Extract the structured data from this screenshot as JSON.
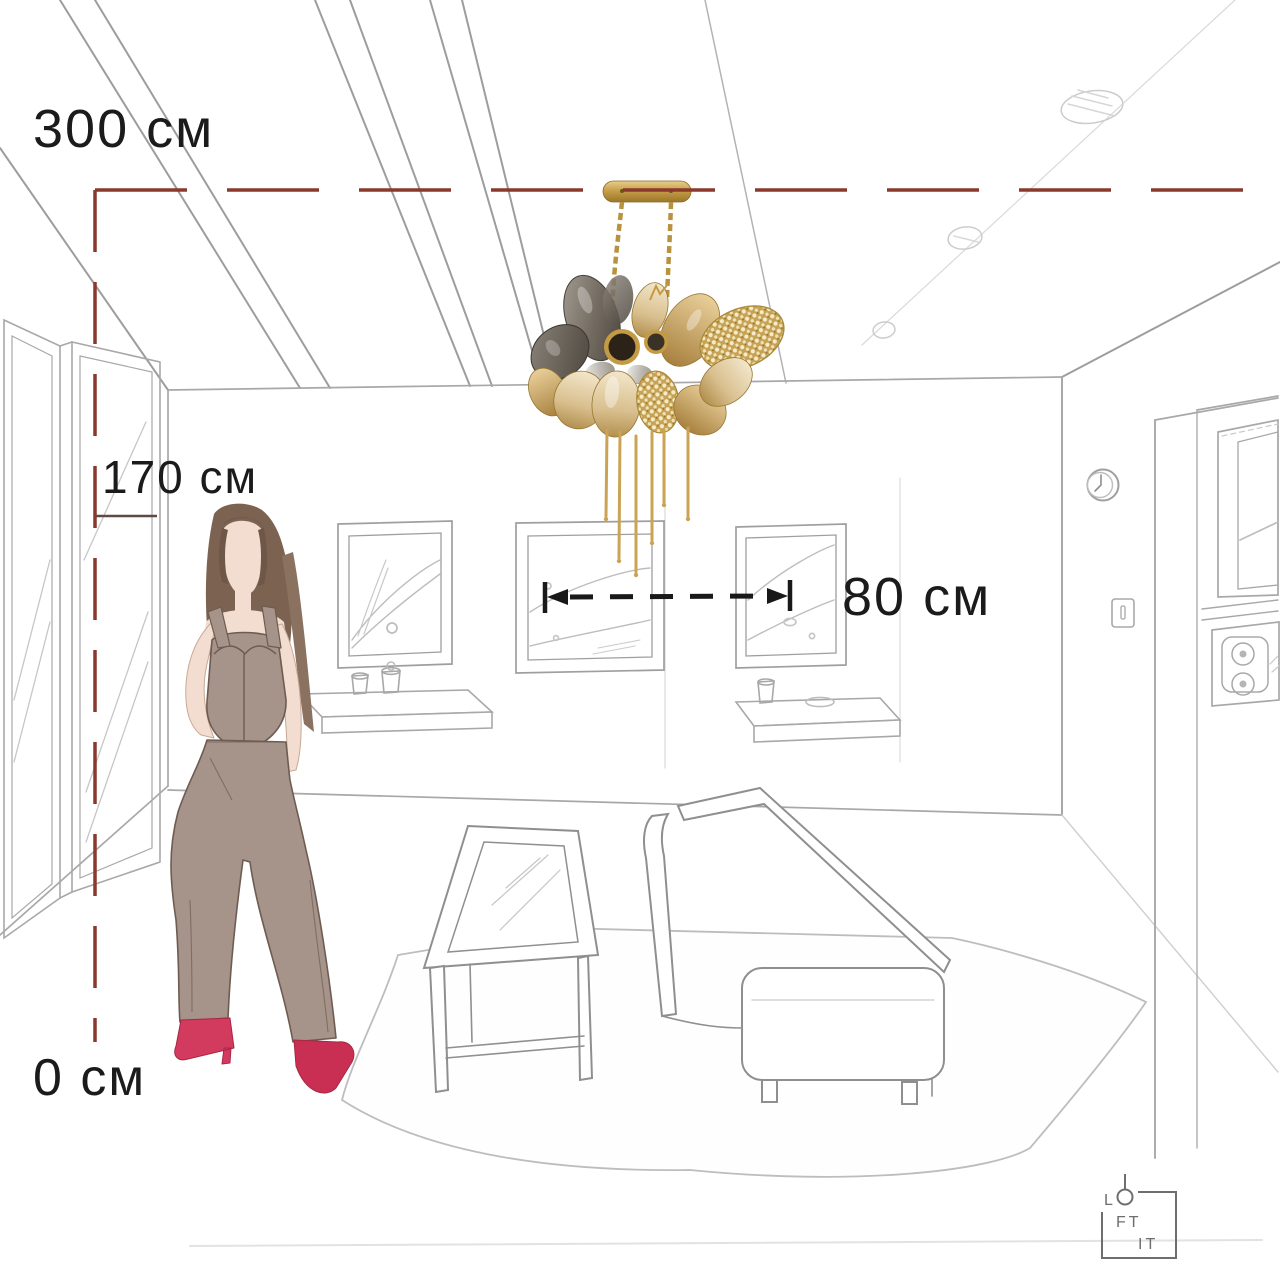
{
  "dimension_labels": {
    "ceiling_height": "300 см",
    "person_height": "170 см",
    "floor_level": "0 см",
    "fixture_width": "80 см"
  },
  "logo": {
    "letter_l": "L",
    "letters_ft": "FT",
    "letters_it": "IT"
  },
  "icons": {
    "logo_o": "pendant-lamp-circle-icon",
    "ceiling_lights": "sketched-ceiling-spot-icons",
    "clock": "wall-clock-icon",
    "switch": "light-switch-icon"
  },
  "colors": {
    "dimension_line_red": "#8a392c",
    "dimension_line_black": "#1a1a1a",
    "label_text": "#1b1b1b",
    "sketch_line_gray": "#a9a9a9",
    "chandelier_gold": "#b8923f",
    "chandelier_smoke": "#5d564c",
    "chandelier_champagne": "#d9bf8e",
    "figure_outfit_taupe": "#a6948b",
    "figure_skin": "#f2ddd0",
    "figure_hair_brown": "#7b6251",
    "figure_shoes_red": "#d23a5e",
    "logo_gray": "#6e6e6e"
  }
}
